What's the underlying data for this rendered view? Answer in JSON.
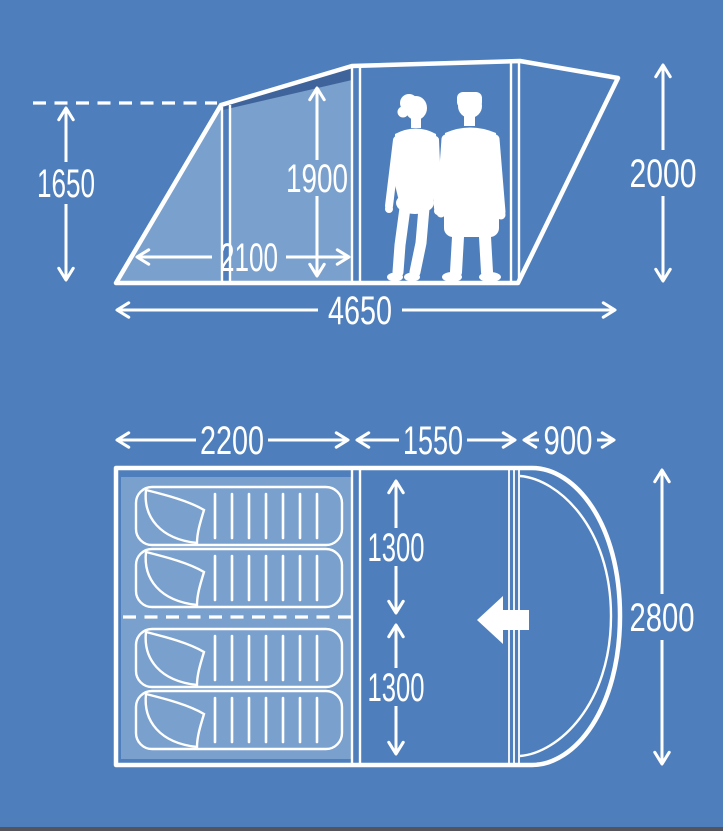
{
  "colors": {
    "background": "#4e7fbc",
    "panel": "#7aa0cd",
    "shadow": "#3f649b",
    "line": "#ffffff",
    "footer_strip": "#54555c"
  },
  "side_view": {
    "label": "tent-side-elevation",
    "dims": {
      "front_height": "1650",
      "inner_height": "1900",
      "front_section_length": "2100",
      "total_length": "4650",
      "rear_height": "2000"
    },
    "figures": "two-people-silhouettes"
  },
  "floor_plan": {
    "label": "tent-floor-plan",
    "dims": {
      "sleeping_area_width": "2200",
      "living_area_width": "1550",
      "porch_width": "900",
      "sleeping_cabin_a_depth": "1300",
      "sleeping_cabin_b_depth": "1300",
      "total_depth": "2800"
    },
    "sleeping_bag_count": 4,
    "door_arrow_direction": "left"
  }
}
